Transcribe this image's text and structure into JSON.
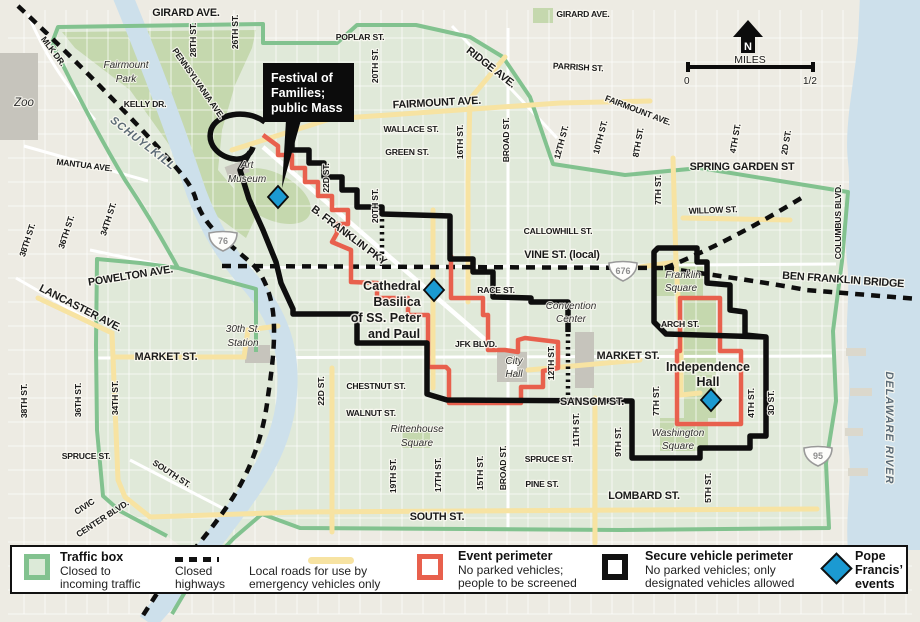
{
  "colors": {
    "bg-outside": "#edebe3",
    "bg-box": "#e0e9d9",
    "park": "#c5d8ae",
    "water": "#cde0eb",
    "green-line": "#82c28f",
    "yellow-road": "#f7e3a2",
    "red-line": "#e8604d",
    "black-line": "#0e0e0e",
    "event-blue": "#1b9ad2",
    "bldg": "#c6c4bc"
  },
  "map": {
    "compass": "N",
    "scale": {
      "label": "MILES",
      "start": "0",
      "end": "1/2"
    },
    "callout": {
      "lines": [
        "Festival of",
        "Families;",
        "public Mass"
      ]
    },
    "shields": [
      {
        "id": "i-76",
        "label": "76",
        "x": 223,
        "y": 241
      },
      {
        "id": "i-676",
        "label": "676",
        "x": 623,
        "y": 271
      },
      {
        "id": "i-95",
        "label": "95",
        "x": 818,
        "y": 456
      }
    ],
    "events": [
      {
        "id": "festival-mass-site",
        "x": 278,
        "y": 197
      },
      {
        "id": "cathedral-basilica",
        "x": 434,
        "y": 290
      },
      {
        "id": "independence-hall",
        "x": 711,
        "y": 400
      }
    ],
    "labels": [
      {
        "n": "girard-ave-w",
        "t": "GIRARD AVE.",
        "x": 186,
        "y": 16,
        "c": "b"
      },
      {
        "n": "girard-ave-e",
        "t": "GIRARD AVE.",
        "x": 583,
        "y": 17,
        "c": "s"
      },
      {
        "n": "poplar-st",
        "t": "POPLAR ST.",
        "x": 360,
        "y": 40,
        "c": "s"
      },
      {
        "n": "ridge-ave",
        "t": "RIDGE AVE.",
        "x": 489,
        "y": 70,
        "r": 38,
        "c": "b"
      },
      {
        "n": "parrish-st",
        "t": "PARRISH ST.",
        "x": 578,
        "y": 70,
        "r": 3,
        "c": "s"
      },
      {
        "n": "fairmount-ave-w",
        "t": "FAIRMOUNT AVE.",
        "x": 437,
        "y": 106,
        "r": -3,
        "c": "b"
      },
      {
        "n": "fairmount-ave-e",
        "t": "FAIRMOUNT AVE.",
        "x": 637,
        "y": 113,
        "r": 21,
        "c": "s"
      },
      {
        "n": "wallace-st",
        "t": "WALLACE ST.",
        "x": 411,
        "y": 132,
        "c": "s"
      },
      {
        "n": "green-st",
        "t": "GREEN ST.",
        "x": 407,
        "y": 155,
        "c": "s"
      },
      {
        "n": "spring-garden-st",
        "t": "SPRING GARDEN ST",
        "x": 742,
        "y": 170,
        "c": "b"
      },
      {
        "n": "willow-st",
        "t": "WILLOW ST.",
        "x": 713,
        "y": 213,
        "r": -2,
        "c": "s"
      },
      {
        "n": "callowhill-st",
        "t": "CALLOWHILL ST.",
        "x": 558,
        "y": 234,
        "c": "s"
      },
      {
        "n": "vine-st-local",
        "t": "VINE ST. (local)",
        "x": 562,
        "y": 258,
        "c": "b"
      },
      {
        "n": "race-st",
        "t": "RACE ST.",
        "x": 496,
        "y": 293,
        "c": "s"
      },
      {
        "n": "arch-st",
        "t": "ARCH ST.",
        "x": 680,
        "y": 327,
        "c": "s"
      },
      {
        "n": "market-st-e",
        "t": "MARKET ST.",
        "x": 628,
        "y": 359,
        "c": "b"
      },
      {
        "n": "market-st-w",
        "t": "MARKET ST.",
        "x": 166,
        "y": 360,
        "c": "b"
      },
      {
        "n": "jfk-blvd",
        "t": "JFK BLVD.",
        "x": 476,
        "y": 347,
        "c": "s"
      },
      {
        "n": "chestnut-st",
        "t": "CHESTNUT ST.",
        "x": 376,
        "y": 389,
        "c": "s"
      },
      {
        "n": "walnut-st",
        "t": "WALNUT ST.",
        "x": 371,
        "y": 416,
        "c": "s"
      },
      {
        "n": "sansom-st",
        "t": "SANSOM ST.",
        "x": 592,
        "y": 405,
        "c": "b"
      },
      {
        "n": "spruce-st-e",
        "t": "SPRUCE ST.",
        "x": 549,
        "y": 462,
        "c": "s"
      },
      {
        "n": "pine-st",
        "t": "PINE ST.",
        "x": 542,
        "y": 487,
        "c": "s"
      },
      {
        "n": "spruce-st-w",
        "t": "SPRUCE ST.",
        "x": 86,
        "y": 459,
        "c": "s"
      },
      {
        "n": "south-st-w",
        "t": "SOUTH ST.",
        "x": 170,
        "y": 476,
        "r": 33,
        "c": "s"
      },
      {
        "n": "south-st-c",
        "t": "SOUTH ST.",
        "x": 437,
        "y": 520,
        "c": "b"
      },
      {
        "n": "lombard-st",
        "t": "LOMBARD ST.",
        "x": 644,
        "y": 499,
        "c": "b"
      },
      {
        "n": "civic-center-blvd-1",
        "t": "CIVIC",
        "x": 86,
        "y": 509,
        "r": -33,
        "c": "s"
      },
      {
        "n": "civic-center-blvd-2",
        "t": "CENTER BLVD.",
        "x": 104,
        "y": 521,
        "r": -33,
        "c": "s"
      },
      {
        "n": "powelton-ave",
        "t": "POWELTON AVE.",
        "x": 131,
        "y": 279,
        "r": -9,
        "c": "b"
      },
      {
        "n": "lancaster-ave",
        "t": "LANCASTER AVE.",
        "x": 79,
        "y": 311,
        "r": 27,
        "c": "b"
      },
      {
        "n": "mantua-ave",
        "t": "MANTUA AVE.",
        "x": 84,
        "y": 168,
        "r": 7,
        "c": "s"
      },
      {
        "n": "mlk-dr",
        "t": "MLK DR.",
        "x": 51,
        "y": 53,
        "r": 53,
        "c": "s"
      },
      {
        "n": "kelly-dr",
        "t": "KELLY DR.",
        "x": 145,
        "y": 107,
        "c": "s"
      },
      {
        "n": "pennsylvania-ave",
        "t": "PENNSYLVANIA AVE.",
        "x": 196,
        "y": 85,
        "r": 55,
        "c": "s"
      },
      {
        "n": "ben-franklin-bridge",
        "t": "BEN FRANKLIN BRIDGE",
        "x": 843,
        "y": 283,
        "r": 4,
        "c": "b"
      },
      {
        "n": "b-franklin-pky",
        "t": "B. FRANKLIN PKY",
        "x": 347,
        "y": 238,
        "r": 37,
        "c": "b"
      },
      {
        "n": "columbus-blvd",
        "t": "COLUMBUS BLVD.",
        "x": 841,
        "y": 222,
        "r": -90,
        "c": "s"
      },
      {
        "n": "schuylkill-river",
        "t": "SCHUYLKILL",
        "x": 141,
        "y": 146,
        "r": 38,
        "c": "w"
      },
      {
        "n": "delaware-river",
        "t": "DELAWARE RIVER",
        "x": 886,
        "y": 428,
        "r": 90,
        "c": "w"
      },
      {
        "n": "28th-st",
        "t": "28TH ST.",
        "x": 196,
        "y": 40,
        "r": -90,
        "c": "v"
      },
      {
        "n": "26th-st",
        "t": "26TH ST.",
        "x": 238,
        "y": 32,
        "r": -90,
        "c": "v"
      },
      {
        "n": "20th-st-n",
        "t": "20TH ST.",
        "x": 378,
        "y": 66,
        "r": -90,
        "c": "v"
      },
      {
        "n": "22d-st-n",
        "t": "22D ST.",
        "x": 329,
        "y": 178,
        "r": -90,
        "c": "v"
      },
      {
        "n": "20th-st-m",
        "t": "20TH ST.",
        "x": 378,
        "y": 206,
        "r": -90,
        "c": "v"
      },
      {
        "n": "16th-st",
        "t": "16TH ST.",
        "x": 463,
        "y": 142,
        "r": -90,
        "c": "v"
      },
      {
        "n": "broad-st-n",
        "t": "BROAD ST.",
        "x": 509,
        "y": 140,
        "r": -90,
        "c": "v"
      },
      {
        "n": "12th-st-n",
        "t": "12TH ST.",
        "x": 564,
        "y": 143,
        "r": -75,
        "c": "v"
      },
      {
        "n": "10th-st",
        "t": "10TH ST.",
        "x": 603,
        "y": 138,
        "r": -75,
        "c": "v"
      },
      {
        "n": "8th-st",
        "t": "8TH ST.",
        "x": 641,
        "y": 143,
        "r": -80,
        "c": "v"
      },
      {
        "n": "7th-st-n",
        "t": "7TH ST.",
        "x": 661,
        "y": 190,
        "r": -90,
        "c": "v"
      },
      {
        "n": "4th-st-n",
        "t": "4TH ST.",
        "x": 738,
        "y": 139,
        "r": -80,
        "c": "v"
      },
      {
        "n": "2d-st-n",
        "t": "2D ST.",
        "x": 789,
        "y": 143,
        "r": -80,
        "c": "v"
      },
      {
        "n": "22d-st-s",
        "t": "22D ST.",
        "x": 324,
        "y": 391,
        "r": -90,
        "c": "v"
      },
      {
        "n": "19th-st",
        "t": "19TH ST.",
        "x": 396,
        "y": 476,
        "r": -90,
        "c": "v"
      },
      {
        "n": "17th-st",
        "t": "17TH ST.",
        "x": 441,
        "y": 475,
        "r": -90,
        "c": "v"
      },
      {
        "n": "15th-st",
        "t": "15TH ST.",
        "x": 483,
        "y": 473,
        "r": -90,
        "c": "v"
      },
      {
        "n": "broad-st-s",
        "t": "BROAD ST.",
        "x": 506,
        "y": 468,
        "r": -90,
        "c": "v"
      },
      {
        "n": "12th-st-s",
        "t": "12TH ST.",
        "x": 554,
        "y": 363,
        "r": -90,
        "c": "v"
      },
      {
        "n": "11th-st",
        "t": "11TH ST.",
        "x": 579,
        "y": 430,
        "r": -90,
        "c": "v"
      },
      {
        "n": "9th-st",
        "t": "9TH ST.",
        "x": 621,
        "y": 442,
        "r": -90,
        "c": "v"
      },
      {
        "n": "7th-st-s",
        "t": "7TH ST.",
        "x": 659,
        "y": 401,
        "r": -90,
        "c": "v"
      },
      {
        "n": "5th-st",
        "t": "5TH ST.",
        "x": 711,
        "y": 488,
        "r": -90,
        "c": "v"
      },
      {
        "n": "4th-st-s",
        "t": "4TH ST.",
        "x": 754,
        "y": 403,
        "r": -90,
        "c": "v"
      },
      {
        "n": "3d-st",
        "t": "3D ST.",
        "x": 774,
        "y": 403,
        "r": -90,
        "c": "v"
      },
      {
        "n": "38th-st-s",
        "t": "38TH ST.",
        "x": 27,
        "y": 401,
        "r": -90,
        "c": "v"
      },
      {
        "n": "36th-st-s",
        "t": "36TH ST.",
        "x": 81,
        "y": 400,
        "r": -90,
        "c": "v"
      },
      {
        "n": "34th-st-s",
        "t": "34TH ST.",
        "x": 118,
        "y": 398,
        "r": -90,
        "c": "v"
      },
      {
        "n": "38th-st-n",
        "t": "38TH ST.",
        "x": 30,
        "y": 241,
        "r": -72,
        "c": "v"
      },
      {
        "n": "36th-st-n",
        "t": "36TH ST.",
        "x": 69,
        "y": 233,
        "r": -72,
        "c": "v"
      },
      {
        "n": "34th-st-n",
        "t": "34TH ST.",
        "x": 111,
        "y": 220,
        "r": -72,
        "c": "v"
      },
      {
        "n": "zoo",
        "t": "Zoo",
        "x": 24,
        "y": 106,
        "c": "pz"
      },
      {
        "n": "fairmount-park-1",
        "t": "Fairmount",
        "x": 126,
        "y": 68,
        "c": "p"
      },
      {
        "n": "fairmount-park-2",
        "t": "Park",
        "x": 126,
        "y": 82,
        "c": "p"
      },
      {
        "n": "art-museum-1",
        "t": "Art",
        "x": 247,
        "y": 168,
        "c": "p"
      },
      {
        "n": "art-museum-2",
        "t": "Museum",
        "x": 247,
        "y": 182,
        "c": "p"
      },
      {
        "n": "30th-st-station-1",
        "t": "30th St.",
        "x": 243,
        "y": 332,
        "c": "p"
      },
      {
        "n": "30th-st-station-2",
        "t": "Station",
        "x": 243,
        "y": 346,
        "c": "p"
      },
      {
        "n": "franklin-square-1",
        "t": "Franklin",
        "x": 683,
        "y": 278,
        "c": "p"
      },
      {
        "n": "franklin-square-2",
        "t": "Square",
        "x": 681,
        "y": 291,
        "c": "p"
      },
      {
        "n": "convention-center-1",
        "t": "Convention",
        "x": 571,
        "y": 309,
        "c": "p"
      },
      {
        "n": "convention-center-2",
        "t": "Center",
        "x": 571,
        "y": 322,
        "c": "p"
      },
      {
        "n": "city-hall-1",
        "t": "City",
        "x": 514,
        "y": 364,
        "c": "p"
      },
      {
        "n": "city-hall-2",
        "t": "Hall",
        "x": 514,
        "y": 377,
        "c": "p"
      },
      {
        "n": "rittenhouse-square-1",
        "t": "Rittenhouse",
        "x": 417,
        "y": 432,
        "c": "p"
      },
      {
        "n": "rittenhouse-square-2",
        "t": "Square",
        "x": 417,
        "y": 446,
        "c": "p"
      },
      {
        "n": "washington-square-1",
        "t": "Washington",
        "x": 678,
        "y": 436,
        "c": "p"
      },
      {
        "n": "washington-square-2",
        "t": "Square",
        "x": 678,
        "y": 449,
        "c": "p"
      },
      {
        "n": "cathedral-1",
        "t": "Cathedral",
        "x": 392,
        "y": 290,
        "c": "poi"
      },
      {
        "n": "cathedral-2",
        "t": "Basilica",
        "x": 397,
        "y": 306,
        "c": "poi"
      },
      {
        "n": "cathedral-3",
        "t": "of SS. Peter",
        "x": 386,
        "y": 322,
        "c": "poi"
      },
      {
        "n": "cathedral-4",
        "t": "and Paul",
        "x": 394,
        "y": 338,
        "c": "poi"
      },
      {
        "n": "independence-hall-1",
        "t": "Independence",
        "x": 708,
        "y": 371,
        "c": "poi"
      },
      {
        "n": "independence-hall-2",
        "t": "Hall",
        "x": 708,
        "y": 386,
        "c": "poi"
      }
    ]
  },
  "legend": {
    "items": [
      {
        "name": "traffic-box",
        "title": "Traffic box",
        "desc": "Closed to\nincoming traffic"
      },
      {
        "name": "closed-highways",
        "title": "",
        "desc": "Closed\nhighways"
      },
      {
        "name": "local-roads",
        "title": "",
        "desc": "Local roads for use by\nemergency vehicles only"
      },
      {
        "name": "event-perimeter",
        "title": "Event perimeter",
        "desc": "No parked vehicles;\npeople to be screened"
      },
      {
        "name": "secure-vehicle-perimeter",
        "title": "Secure vehicle perimeter",
        "desc": "No parked vehicles; only\ndesignated vehicles allowed"
      },
      {
        "name": "pope-francis-events",
        "title": "Pope\nFrancis’\nevents",
        "desc": ""
      }
    ]
  }
}
